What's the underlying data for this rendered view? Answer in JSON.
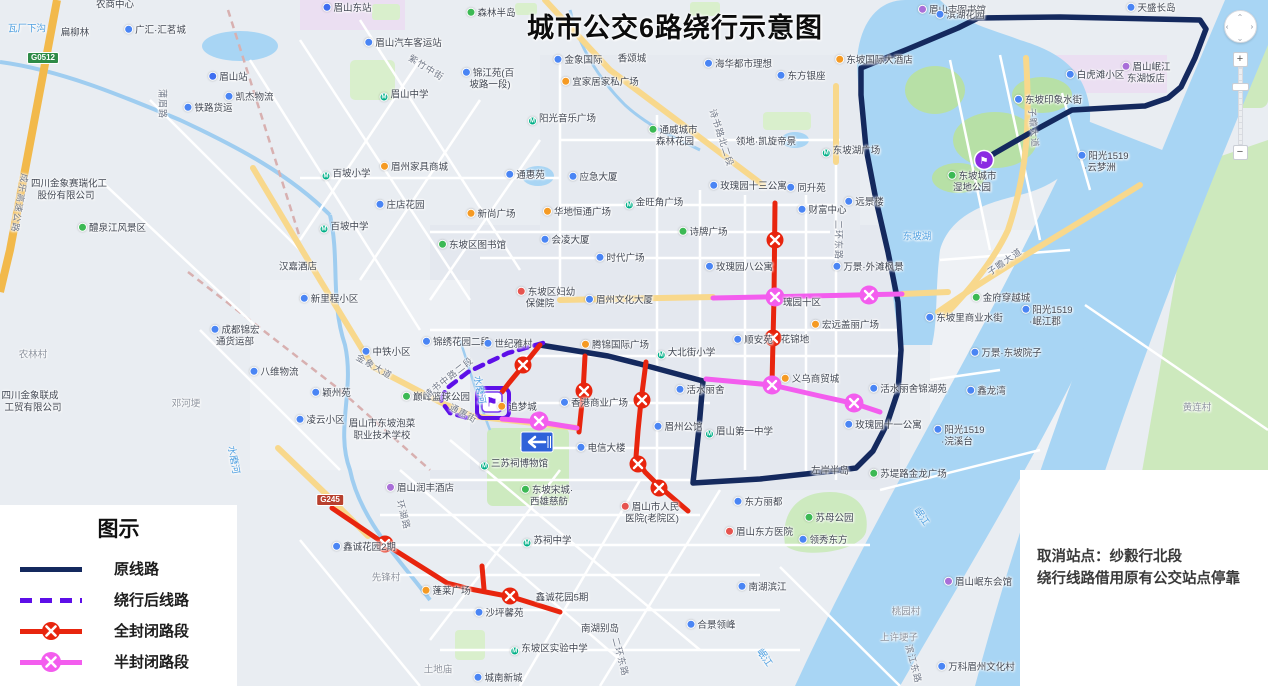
{
  "title": "城市公交6路绕行示意图",
  "legend": {
    "title": "图示",
    "items": [
      {
        "label": "原线路",
        "type": "solid",
        "color": "#14295e"
      },
      {
        "label": "绕行后线路",
        "type": "dashed",
        "color": "#5d0fe8"
      },
      {
        "label": "全封闭路段",
        "type": "closed",
        "color": "#e8250e"
      },
      {
        "label": "半封闭路段",
        "type": "half",
        "color": "#f35dee"
      }
    ]
  },
  "notice": {
    "line1": "取消站点：纱縠行北段",
    "line2": "绕行线路借用原有公交站点停靠"
  },
  "controls": {
    "zoom_in": "+",
    "zoom_out": "−",
    "pan_glyph": "⌃"
  },
  "colors": {
    "original": "#14295e",
    "detour": "#5d0fe8",
    "closed": "#e8250e",
    "half": "#f35dee",
    "water": "#a8d5f4",
    "park": "#c9e7b7",
    "road_yellow": "#f8d88c"
  },
  "routes": {
    "original": {
      "color": "#14295e",
      "width": 5.5,
      "points": [
        [
          540,
          345
        ],
        [
          608,
          356
        ],
        [
          640,
          364
        ],
        [
          703,
          381
        ],
        [
          699,
          428
        ],
        [
          693,
          483
        ],
        [
          760,
          479
        ],
        [
          833,
          471
        ],
        [
          856,
          468
        ],
        [
          873,
          451
        ],
        [
          887,
          424
        ],
        [
          898,
          391
        ],
        [
          901,
          350
        ],
        [
          898,
          302
        ],
        [
          888,
          252
        ],
        [
          876,
          200
        ],
        [
          866,
          148
        ],
        [
          861,
          95
        ],
        [
          861,
          68
        ],
        [
          908,
          49
        ],
        [
          958,
          28
        ],
        [
          978,
          18
        ],
        [
          1060,
          17
        ],
        [
          1200,
          20
        ],
        [
          1206,
          29
        ],
        [
          1195,
          58
        ],
        [
          1181,
          87
        ],
        [
          1168,
          98
        ],
        [
          1145,
          106
        ],
        [
          1072,
          110
        ],
        [
          1028,
          134
        ],
        [
          995,
          153
        ],
        [
          984,
          160
        ]
      ]
    },
    "detour": {
      "color": "#5d0fe8",
      "width": 4.5,
      "dash": "9 7",
      "points": [
        [
          543,
          343
        ],
        [
          508,
          353
        ],
        [
          468,
          372
        ],
        [
          446,
          389
        ],
        [
          441,
          401
        ],
        [
          450,
          413
        ],
        [
          468,
          418
        ]
      ],
      "loop": {
        "x": 477,
        "y": 388,
        "w": 32,
        "h": 30
      }
    },
    "closed": {
      "color": "#e8250e",
      "width": 5,
      "segments": [
        {
          "points": [
            [
              540,
              345
            ],
            [
              523,
              366
            ],
            [
              509,
              383
            ],
            [
              502,
              392
            ]
          ],
          "x": [
            [
              523,
              365
            ]
          ]
        },
        {
          "points": [
            [
              585,
              356
            ],
            [
              583,
              393
            ],
            [
              579,
              432
            ]
          ],
          "x": [
            [
              584,
              391
            ]
          ]
        },
        {
          "points": [
            [
              646,
              362
            ],
            [
              641,
              401
            ],
            [
              638,
              431
            ],
            [
              636,
              457
            ],
            [
              645,
              472
            ],
            [
              660,
              487
            ],
            [
              688,
              511
            ]
          ],
          "x": [
            [
              642,
              400
            ],
            [
              638,
              464
            ],
            [
              659,
              488
            ]
          ]
        },
        {
          "points": [
            [
              775,
              203
            ],
            [
              774,
              297
            ],
            [
              772,
              384
            ]
          ],
          "x": [
            [
              775,
              240
            ],
            [
              773,
              338
            ]
          ]
        },
        {
          "points": [
            [
              332,
              508
            ],
            [
              385,
              544
            ],
            [
              447,
              583
            ],
            [
              470,
              589
            ],
            [
              512,
              597
            ],
            [
              560,
              612
            ]
          ],
          "x": [
            [
              385,
              544
            ],
            [
              510,
              596
            ]
          ]
        },
        {
          "points": [
            [
              482,
              566
            ],
            [
              484,
              589
            ]
          ],
          "x": []
        }
      ]
    },
    "half": {
      "color": "#f35dee",
      "width": 5,
      "segments": [
        {
          "points": [
            [
              713,
              298
            ],
            [
              902,
              294
            ]
          ],
          "x": [
            [
              775,
              297
            ],
            [
              869,
              295
            ]
          ]
        },
        {
          "points": [
            [
              706,
              379
            ],
            [
              772,
              385
            ],
            [
              820,
              396
            ],
            [
              856,
              404
            ],
            [
              880,
              412
            ]
          ],
          "x": [
            [
              772,
              385
            ],
            [
              854,
              403
            ]
          ]
        },
        {
          "points": [
            [
              502,
              419
            ],
            [
              540,
              422
            ],
            [
              577,
              428
            ]
          ],
          "x": [
            [
              539,
              421
            ]
          ]
        }
      ]
    },
    "terminals": [
      {
        "x": 492,
        "y": 402,
        "style": "box"
      },
      {
        "x": 984,
        "y": 160,
        "style": "circle"
      }
    ],
    "oneway_sign": {
      "x": 537,
      "y": 442
    }
  },
  "labels": [
    {
      "t": "瓦厂下沟",
      "x": 27,
      "y": 29,
      "c": "water"
    },
    {
      "t": "扁柳林",
      "x": 75,
      "y": 33
    },
    {
      "t": "农商中心",
      "x": 115,
      "y": 5
    },
    {
      "t": "广汇·汇茗城",
      "x": 155,
      "y": 30,
      "ic": "blue"
    },
    {
      "t": "G0512",
      "x": 43,
      "y": 58,
      "c": "bgreen"
    },
    {
      "t": "眉山站",
      "x": 228,
      "y": 77,
      "ic": "train"
    },
    {
      "t": "铁路货运",
      "x": 208,
      "y": 108,
      "ic": "blue"
    },
    {
      "t": "凯杰物流",
      "x": 249,
      "y": 97,
      "ic": "blue"
    },
    {
      "t": "蒲眉路",
      "x": 162,
      "y": 104,
      "r": 90,
      "c": "road"
    },
    {
      "t": "成乐高速公路",
      "x": 19,
      "y": 203,
      "r": 100,
      "c": "road"
    },
    {
      "t": "四川金象赛瑞化工",
      "x": 69,
      "y": 184
    },
    {
      "t": "股份有限公司",
      "x": 66,
      "y": 196
    },
    {
      "t": "醴泉江风景区",
      "x": 112,
      "y": 228,
      "ic": "green"
    },
    {
      "t": "农林村",
      "x": 33,
      "y": 355,
      "c": "village"
    },
    {
      "t": "邓河埂",
      "x": 186,
      "y": 404,
      "c": "village"
    },
    {
      "t": "四川金象联成",
      "x": 30,
      "y": 396
    },
    {
      "t": "工贸有限公司",
      "x": 33,
      "y": 408
    },
    {
      "t": "水磨河",
      "x": 233,
      "y": 460,
      "r": 80,
      "c": "water"
    },
    {
      "t": "成都锦宏",
      "x": 235,
      "y": 330,
      "ic": "blue"
    },
    {
      "t": "通货运部",
      "x": 235,
      "y": 342
    },
    {
      "t": "新里程小区",
      "x": 329,
      "y": 299,
      "ic": "blue"
    },
    {
      "t": "中铁小区",
      "x": 386,
      "y": 352,
      "ic": "blue"
    },
    {
      "t": "金象大道",
      "x": 374,
      "y": 367,
      "r": 30,
      "c": "road"
    },
    {
      "t": "八维物流",
      "x": 274,
      "y": 372,
      "ic": "blue"
    },
    {
      "t": "颖州苑",
      "x": 331,
      "y": 393,
      "ic": "blue"
    },
    {
      "t": "凌云小区",
      "x": 320,
      "y": 420,
      "ic": "blue"
    },
    {
      "t": "眉山市东坡泡菜",
      "x": 382,
      "y": 424
    },
    {
      "t": "职业技术学校",
      "x": 382,
      "y": 436
    },
    {
      "t": "巅峰篮球公园",
      "x": 436,
      "y": 397,
      "ic": "green"
    },
    {
      "t": "锦绣花园二段",
      "x": 456,
      "y": 342,
      "ic": "blue"
    },
    {
      "t": "世纪雅村",
      "x": 508,
      "y": 344,
      "ic": "blue"
    },
    {
      "t": "诗书中路二段",
      "x": 449,
      "y": 378,
      "r": -38,
      "c": "road"
    },
    {
      "t": "通惠街",
      "x": 463,
      "y": 414,
      "r": 28,
      "c": "road"
    },
    {
      "t": "水磨河",
      "x": 479,
      "y": 390,
      "r": 80,
      "c": "water"
    },
    {
      "t": "眉山东站",
      "x": 347,
      "y": 8,
      "ic": "train"
    },
    {
      "t": "森林半岛",
      "x": 491,
      "y": 13,
      "ic": "green"
    },
    {
      "t": "眉山汽车客运站",
      "x": 403,
      "y": 43,
      "ic": "blue"
    },
    {
      "t": "紫竹中街",
      "x": 426,
      "y": 68,
      "r": 32,
      "c": "road"
    },
    {
      "t": "眉山中学",
      "x": 404,
      "y": 96,
      "ic": "teal"
    },
    {
      "t": "锦江苑(百",
      "x": 488,
      "y": 73,
      "ic": "blue"
    },
    {
      "t": "坡路一段)",
      "x": 490,
      "y": 85
    },
    {
      "t": "宜家居家私广场",
      "x": 600,
      "y": 82,
      "ic": "orange"
    },
    {
      "t": "金象国际",
      "x": 578,
      "y": 60,
      "ic": "blue"
    },
    {
      "t": "香颂城",
      "x": 632,
      "y": 59
    },
    {
      "t": "海华都市理想",
      "x": 738,
      "y": 64,
      "ic": "blue"
    },
    {
      "t": "东方银座",
      "x": 801,
      "y": 76,
      "ic": "blue"
    },
    {
      "t": "眉山市图书馆",
      "x": 952,
      "y": 10,
      "ic": "purple"
    },
    {
      "t": "阳光音乐广场",
      "x": 562,
      "y": 120,
      "ic": "teal"
    },
    {
      "t": "百坡小学",
      "x": 346,
      "y": 175,
      "ic": "teal"
    },
    {
      "t": "眉州家具商城",
      "x": 414,
      "y": 167,
      "ic": "orange"
    },
    {
      "t": "庄店花园",
      "x": 400,
      "y": 205,
      "ic": "blue"
    },
    {
      "t": "百坡中学",
      "x": 344,
      "y": 228,
      "ic": "teal"
    },
    {
      "t": "汉嘉酒店",
      "x": 298,
      "y": 267
    },
    {
      "t": "新尚广场",
      "x": 491,
      "y": 214,
      "ic": "orange"
    },
    {
      "t": "通惠苑",
      "x": 525,
      "y": 175,
      "ic": "blue"
    },
    {
      "t": "应急大厦",
      "x": 593,
      "y": 177,
      "ic": "blue"
    },
    {
      "t": "华地恒通广场",
      "x": 577,
      "y": 212,
      "ic": "orange"
    },
    {
      "t": "通威城市",
      "x": 673,
      "y": 130,
      "ic": "green"
    },
    {
      "t": "森林花园",
      "x": 675,
      "y": 142
    },
    {
      "t": "诗书路北二段",
      "x": 721,
      "y": 138,
      "r": 72,
      "c": "road"
    },
    {
      "t": "领地·凯旋帝景",
      "x": 766,
      "y": 142
    },
    {
      "t": "东坡湖广场",
      "x": 851,
      "y": 152,
      "ic": "teal"
    },
    {
      "t": "玫瑰园十三公寓",
      "x": 748,
      "y": 186,
      "ic": "blue"
    },
    {
      "t": "同升苑",
      "x": 806,
      "y": 188,
      "ic": "blue"
    },
    {
      "t": "金旺角广场",
      "x": 654,
      "y": 204,
      "ic": "teal"
    },
    {
      "t": "财富中心",
      "x": 822,
      "y": 210,
      "ic": "blue"
    },
    {
      "t": "远景楼",
      "x": 864,
      "y": 202,
      "ic": "blue"
    },
    {
      "t": "诗牌广场",
      "x": 703,
      "y": 232,
      "ic": "green"
    },
    {
      "t": "二环东路",
      "x": 838,
      "y": 240,
      "r": 90,
      "c": "road"
    },
    {
      "t": "东坡湖",
      "x": 917,
      "y": 237,
      "c": "water"
    },
    {
      "t": "会凌大厦",
      "x": 565,
      "y": 240,
      "ic": "blue"
    },
    {
      "t": "时代广场",
      "x": 620,
      "y": 258,
      "ic": "blue"
    },
    {
      "t": "东坡区图书馆",
      "x": 472,
      "y": 245,
      "ic": "green"
    },
    {
      "t": "玫瑰园八公寓",
      "x": 739,
      "y": 267,
      "ic": "blue"
    },
    {
      "t": "万景·外滩枫景",
      "x": 868,
      "y": 267,
      "ic": "blue"
    },
    {
      "t": "东坡区妇幼",
      "x": 546,
      "y": 292,
      "ic": "red"
    },
    {
      "t": "保健院",
      "x": 540,
      "y": 304
    },
    {
      "t": "眉州文化大厦",
      "x": 619,
      "y": 300,
      "ic": "blue"
    },
    {
      "t": "腾锦国际广场",
      "x": 615,
      "y": 345,
      "ic": "orange"
    },
    {
      "t": "大北街小学",
      "x": 686,
      "y": 354,
      "ic": "teal"
    },
    {
      "t": "瑰园十区",
      "x": 802,
      "y": 303
    },
    {
      "t": "宏远盖丽广场",
      "x": 845,
      "y": 325,
      "ic": "orange"
    },
    {
      "t": "顺安苑",
      "x": 753,
      "y": 340,
      "ic": "blue"
    },
    {
      "t": "花锦地",
      "x": 795,
      "y": 340
    },
    {
      "t": "义乌商贸城",
      "x": 810,
      "y": 379,
      "ic": "orange"
    },
    {
      "t": "活水丽舍",
      "x": 700,
      "y": 390,
      "ic": "blue"
    },
    {
      "t": "活水丽舍锦湖苑",
      "x": 908,
      "y": 389,
      "ic": "blue"
    },
    {
      "t": "香港商业广场",
      "x": 594,
      "y": 403,
      "ic": "blue"
    },
    {
      "t": "追梦城",
      "x": 517,
      "y": 407,
      "ic": "orange"
    },
    {
      "t": "眉州公馆",
      "x": 678,
      "y": 427,
      "ic": "blue"
    },
    {
      "t": "眉山第一中学",
      "x": 739,
      "y": 433,
      "ic": "teal"
    },
    {
      "t": "玫瑰园十一公寓",
      "x": 883,
      "y": 425,
      "ic": "blue"
    },
    {
      "t": "电信大楼",
      "x": 601,
      "y": 448,
      "ic": "blue"
    },
    {
      "t": "三苏祠博物馆",
      "x": 514,
      "y": 465,
      "ic": "teal"
    },
    {
      "t": "东坡宋城·",
      "x": 547,
      "y": 490,
      "ic": "green"
    },
    {
      "t": "西雄慈舫",
      "x": 549,
      "y": 502
    },
    {
      "t": "苏祠中学",
      "x": 547,
      "y": 542,
      "ic": "teal"
    },
    {
      "t": "眉山润丰酒店",
      "x": 420,
      "y": 488,
      "ic": "purple"
    },
    {
      "t": "环湖路",
      "x": 403,
      "y": 515,
      "r": 75,
      "c": "road"
    },
    {
      "t": "G245",
      "x": 330,
      "y": 500,
      "c": "bred"
    },
    {
      "t": "鑫诚花园2期",
      "x": 364,
      "y": 547,
      "ic": "blue"
    },
    {
      "t": "先锋村",
      "x": 386,
      "y": 578,
      "c": "village"
    },
    {
      "t": "蓬莱广场",
      "x": 446,
      "y": 591,
      "ic": "orange"
    },
    {
      "t": "沙坪馨苑",
      "x": 499,
      "y": 613,
      "ic": "blue"
    },
    {
      "t": "鑫诚花园5期",
      "x": 562,
      "y": 598
    },
    {
      "t": "眉山市人民",
      "x": 650,
      "y": 507,
      "ic": "red"
    },
    {
      "t": "医院(老院区)",
      "x": 652,
      "y": 519
    },
    {
      "t": "东坡区实验中学",
      "x": 549,
      "y": 650,
      "ic": "teal"
    },
    {
      "t": "城南新城",
      "x": 498,
      "y": 678,
      "ic": "blue"
    },
    {
      "t": "土地庙",
      "x": 438,
      "y": 670,
      "c": "village"
    },
    {
      "t": "南湖别岛",
      "x": 600,
      "y": 629
    },
    {
      "t": "二环东路",
      "x": 620,
      "y": 657,
      "r": 75,
      "c": "road"
    },
    {
      "t": "东方丽都",
      "x": 758,
      "y": 502,
      "ic": "blue"
    },
    {
      "t": "苏母公园",
      "x": 829,
      "y": 518,
      "ic": "green"
    },
    {
      "t": "眉山东方医院",
      "x": 759,
      "y": 532,
      "ic": "red"
    },
    {
      "t": "领秀东方",
      "x": 823,
      "y": 540,
      "ic": "blue"
    },
    {
      "t": "南湖滨江",
      "x": 762,
      "y": 587,
      "ic": "blue"
    },
    {
      "t": "合景领峰",
      "x": 711,
      "y": 625,
      "ic": "blue"
    },
    {
      "t": "左岸半岛",
      "x": 830,
      "y": 471
    },
    {
      "t": "苏堤路金龙广场",
      "x": 908,
      "y": 474,
      "ic": "green"
    },
    {
      "t": "岷江",
      "x": 921,
      "y": 517,
      "r": 55,
      "c": "water"
    },
    {
      "t": "岷江",
      "x": 764,
      "y": 658,
      "r": 55,
      "c": "water"
    },
    {
      "t": "眉山岷东会馆",
      "x": 978,
      "y": 582,
      "ic": "purple"
    },
    {
      "t": "桃园村",
      "x": 906,
      "y": 612,
      "c": "village"
    },
    {
      "t": "上许埂子",
      "x": 899,
      "y": 638,
      "c": "village"
    },
    {
      "t": "滨江东路",
      "x": 913,
      "y": 664,
      "r": 75,
      "c": "road"
    },
    {
      "t": "万科眉州文化村",
      "x": 976,
      "y": 667,
      "ic": "blue"
    },
    {
      "t": "黄连村",
      "x": 1197,
      "y": 408,
      "c": "village"
    },
    {
      "t": "滨湖花园",
      "x": 960,
      "y": 15,
      "ic": "blue"
    },
    {
      "t": "天盛长岛",
      "x": 1151,
      "y": 8,
      "ic": "blue"
    },
    {
      "t": "东坡国际大酒店",
      "x": 874,
      "y": 60,
      "ic": "orange"
    },
    {
      "t": "白虎滩小区",
      "x": 1095,
      "y": 75,
      "ic": "blue"
    },
    {
      "t": "眉山岷江",
      "x": 1146,
      "y": 67,
      "ic": "purple"
    },
    {
      "t": "东湖饭店",
      "x": 1146,
      "y": 79
    },
    {
      "t": "东坡印象水街",
      "x": 1048,
      "y": 100,
      "ic": "blue"
    },
    {
      "t": "子瞻大道",
      "x": 1033,
      "y": 128,
      "r": 85,
      "c": "road"
    },
    {
      "t": "子瞻大道",
      "x": 1005,
      "y": 262,
      "r": -35,
      "c": "road"
    },
    {
      "t": "东坡城市",
      "x": 972,
      "y": 176,
      "ic": "green"
    },
    {
      "t": "湿地公园",
      "x": 972,
      "y": 188
    },
    {
      "t": "阳光1519",
      "x": 1103,
      "y": 156,
      "ic": "blue"
    },
    {
      "t": "·云梦洲",
      "x": 1100,
      "y": 168
    },
    {
      "t": "金府穿越城",
      "x": 1001,
      "y": 298,
      "ic": "green"
    },
    {
      "t": "阳光1519",
      "x": 1047,
      "y": 310,
      "ic": "blue"
    },
    {
      "t": "·岷江郡",
      "x": 1045,
      "y": 322
    },
    {
      "t": "东坡里商业水街",
      "x": 964,
      "y": 318,
      "ic": "blue"
    },
    {
      "t": "万景·东坡院子",
      "x": 1006,
      "y": 353,
      "ic": "blue"
    },
    {
      "t": "鑫龙湾",
      "x": 986,
      "y": 391,
      "ic": "blue"
    },
    {
      "t": "阳光1519",
      "x": 959,
      "y": 430,
      "ic": "blue"
    },
    {
      "t": "·浣溪台",
      "x": 957,
      "y": 442
    }
  ]
}
